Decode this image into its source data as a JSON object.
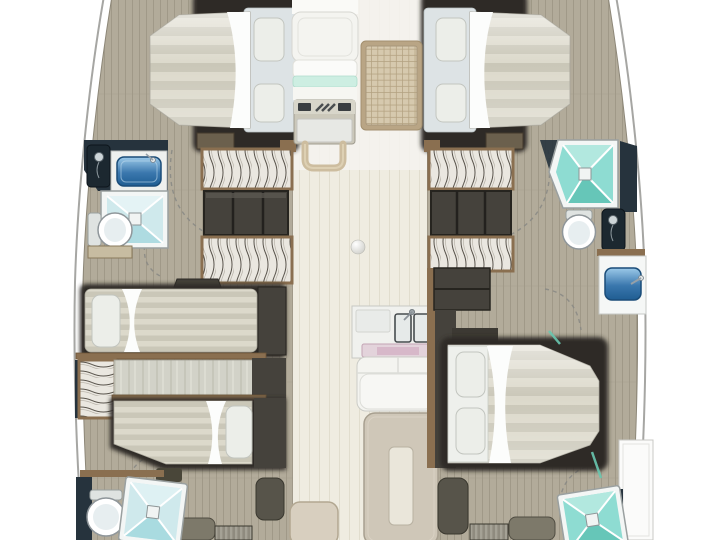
{
  "page": {
    "label": "Catamaran yacht deck plan, top view, bow at top, no text labels",
    "background": "#ffffff"
  },
  "palette": {
    "hull-line": "#a6a6a3",
    "deck-wood": "#b2ab9a",
    "deck-line": "#a09988",
    "saloon-floor": "#efece1",
    "saloon-line": "#e1ddce",
    "dark-frame": "#2f2c26",
    "charcoal": "#45423c",
    "cab-brown": "#8a6f50",
    "navy": "#26333d",
    "mattress-a": "#dcd9cb",
    "mattress-b": "#cac7b8",
    "pillow": "#eceee9",
    "duvet": "#fcfdfc",
    "head-panel": "#dde3e5",
    "teal": "#8edcd2",
    "teal-light": "#cfe9ec",
    "shower-frame": "#f3f6f5",
    "sink-blue-deep": "#1f5d92",
    "seat-white": "#f4f4f0",
    "aqua": "#cdeee2",
    "mat-tan": "#d6c9ae",
    "mat-border": "#b9a585",
    "mat-line": "#b3a281",
    "olive": "#7d796a",
    "olive-dark": "#57544a",
    "table-beige": "#cfc7b8",
    "table-inset": "#eae6da",
    "galley-pink": "#d3b2c4",
    "console-grey": "#cbc8ba",
    "arc-grey": "#8a8a85",
    "glass-teal": "#69c7b0",
    "silver": "#9aa0a0"
  },
  "inventory": {
    "bridgedeck": {
      "bow_cockpit": [
        "bench-seat",
        "aqua-cushion",
        "console",
        "grab-handle",
        "woven-mat"
      ],
      "saloon": [
        "deck-light",
        "galley-counter",
        "twin-galley-sinks",
        "cooktop-strip",
        "sofa",
        "dining-table",
        "entry-step"
      ]
    },
    "port_hull": {
      "forward_cabin": [
        "double-berth",
        "two-pillows",
        "duvet-fold",
        "hanging-wardrobe",
        "lockers"
      ],
      "forward_head": [
        "shower-mixer",
        "washbasin",
        "shower-tray",
        "toilet",
        "vanity"
      ],
      "aft_cabin": [
        "single-berth",
        "single-berth",
        "hanging-locker",
        "trim-rails",
        "ottoman",
        "bench",
        "step-drawers"
      ],
      "aft_head": [
        "toilet",
        "shower-tray"
      ]
    },
    "starboard_hull": {
      "forward_cabin": [
        "double-berth",
        "two-pillows",
        "duvet-fold",
        "hanging-wardrobe",
        "lockers"
      ],
      "forward_head": [
        "shower-tray",
        "toilet",
        "shower-mixer",
        "washbasin-cabinet"
      ],
      "aft_cabin": [
        "double-berth",
        "two-pillows",
        "duvet-fold",
        "headboard-lockers",
        "ottoman",
        "bench",
        "step-drawers"
      ],
      "aft_head": [
        "shower-tray",
        "glass-door",
        "cabinet"
      ]
    },
    "counts": {
      "cabins": 4,
      "heads": 4,
      "berths": 5,
      "showers": 4,
      "toilets": 4,
      "washbasins": 2,
      "galley_sinks": 2
    }
  }
}
